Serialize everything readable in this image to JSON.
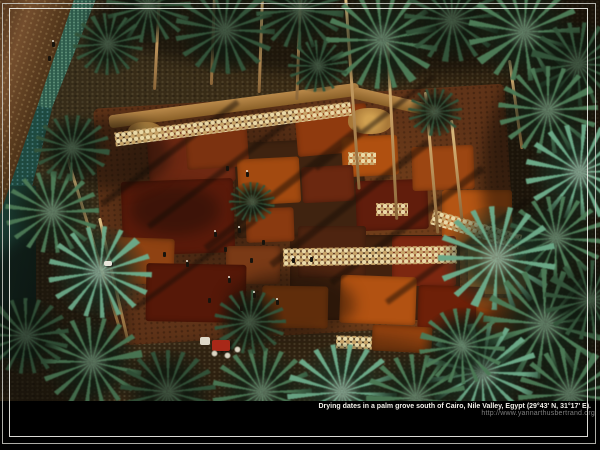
{
  "window": {
    "width": 600,
    "height": 450,
    "background": "#000000"
  },
  "caption": {
    "text": "Drying dates in a palm grove south of Cairo, Nile Valley, Egypt (29°43' N, 31°17' E).",
    "url": "http://www.yannarthusbertrand.org",
    "text_color": "#f2f0ea",
    "url_color": "#7e7e7e"
  },
  "frame": {
    "outer_color": "#cdcdc6",
    "inner_color": "#f3f2ec"
  },
  "photo": {
    "description": "Aerial photograph of dates spread to dry in red, orange and brown rectangular patches on the ground of a palm grove south of Cairo; tall palms cast long diagonal shadows; workers, rows of cream sacks, straw piles, a white donkey, a red tractor, a dirt road, an irrigation canal and teal-green crop fields border the scene.",
    "palette": {
      "ground": "#352818",
      "ground_light": "#4a3520",
      "field_teal": "#2e5c4c",
      "field_dark": "#1e4a40",
      "canal": "#16332a",
      "road": "#6b4528",
      "yard": "#5f3318",
      "straw": "#b9894a",
      "sack": "#ead9a6",
      "trunk": "#c9a065",
      "shadow": "#190f08",
      "tractor_red": "#a82818",
      "tractor_canopy": "#ded8c8",
      "animal_white": "#e9e6dc",
      "palm_variants": [
        {
          "frond": "#33543a",
          "hl": "rgba(150,180,150,.28)",
          "center": "rgba(16,26,16,.88)"
        },
        {
          "frond": "#4c7a56",
          "hl": "rgba(190,225,195,.35)",
          "center": "rgba(20,34,22,.85)"
        },
        {
          "frond": "#6ba887",
          "hl": "rgba(222,246,228,.4)",
          "center": "rgba(28,50,36,.8)"
        }
      ]
    },
    "patches": [
      {
        "x": 235,
        "y": 140,
        "w": 130,
        "h": 95,
        "c": "#3f2310",
        "r": -3
      },
      {
        "x": 290,
        "y": 235,
        "w": 170,
        "h": 85,
        "c": "#42210e",
        "r": 0
      },
      {
        "x": 148,
        "y": 126,
        "w": 86,
        "h": 58,
        "c": "#6e2812",
        "r": -4
      },
      {
        "x": 186,
        "y": 128,
        "w": 62,
        "h": 40,
        "c": "#7c3210",
        "r": -4
      },
      {
        "x": 122,
        "y": 180,
        "w": 112,
        "h": 74,
        "c": "#5a1a0a",
        "r": -2
      },
      {
        "x": 238,
        "y": 158,
        "w": 62,
        "h": 46,
        "c": "#a34a10",
        "r": -3
      },
      {
        "x": 296,
        "y": 106,
        "w": 72,
        "h": 48,
        "c": "#8f3a0e",
        "r": -5
      },
      {
        "x": 342,
        "y": 136,
        "w": 56,
        "h": 40,
        "c": "#b05010",
        "r": -3
      },
      {
        "x": 302,
        "y": 166,
        "w": 52,
        "h": 36,
        "c": "#6b2810",
        "r": -3
      },
      {
        "x": 356,
        "y": 180,
        "w": 72,
        "h": 50,
        "c": "#611d0c",
        "r": -2
      },
      {
        "x": 412,
        "y": 146,
        "w": 62,
        "h": 44,
        "c": "#9c4612",
        "r": -2
      },
      {
        "x": 442,
        "y": 190,
        "w": 70,
        "h": 54,
        "c": "#b45514",
        "r": 0
      },
      {
        "x": 468,
        "y": 246,
        "w": 58,
        "h": 48,
        "c": "#c0702a",
        "r": 0
      },
      {
        "x": 392,
        "y": 236,
        "w": 64,
        "h": 50,
        "c": "#7c2710",
        "r": 0
      },
      {
        "x": 298,
        "y": 226,
        "w": 68,
        "h": 52,
        "c": "#4e2410",
        "r": 0
      },
      {
        "x": 246,
        "y": 208,
        "w": 48,
        "h": 34,
        "c": "#8a3a10",
        "r": -2
      },
      {
        "x": 226,
        "y": 246,
        "w": 54,
        "h": 38,
        "c": "#7a3a16",
        "r": 0
      },
      {
        "x": 116,
        "y": 238,
        "w": 58,
        "h": 46,
        "c": "#8f4212",
        "r": 2
      },
      {
        "x": 146,
        "y": 264,
        "w": 100,
        "h": 58,
        "c": "#561808",
        "r": 1
      },
      {
        "x": 262,
        "y": 286,
        "w": 66,
        "h": 42,
        "c": "#a04a12",
        "r": 1
      },
      {
        "x": 340,
        "y": 276,
        "w": 76,
        "h": 48,
        "c": "#b25212",
        "r": 2
      },
      {
        "x": 418,
        "y": 286,
        "w": 66,
        "h": 44,
        "c": "#6e2008",
        "r": 2
      },
      {
        "x": 476,
        "y": 298,
        "w": 52,
        "h": 36,
        "c": "#a84c12",
        "r": 2
      },
      {
        "x": 372,
        "y": 326,
        "w": 60,
        "h": 26,
        "c": "#94420f",
        "r": 3
      }
    ],
    "straw_rows": [
      {
        "x": 108,
        "y": 99,
        "w": 252,
        "h": 13,
        "r": -7.5
      },
      {
        "x": 352,
        "y": 96,
        "w": 84,
        "h": 12,
        "r": 13
      }
    ],
    "straw_piles": [
      {
        "x": 348,
        "y": 108,
        "w": 44,
        "h": 26
      },
      {
        "x": 128,
        "y": 122,
        "w": 34,
        "h": 20
      }
    ],
    "shadow_lines": [
      {
        "x": 85,
        "y": 150,
        "w": 170,
        "h": 6,
        "r": -37
      },
      {
        "x": 130,
        "y": 168,
        "w": 185,
        "h": 6,
        "r": -37
      },
      {
        "x": 185,
        "y": 185,
        "w": 195,
        "h": 7,
        "r": -38
      },
      {
        "x": 250,
        "y": 200,
        "w": 200,
        "h": 7,
        "r": -38
      },
      {
        "x": 312,
        "y": 222,
        "w": 190,
        "h": 7,
        "r": -37
      },
      {
        "x": 370,
        "y": 248,
        "w": 175,
        "h": 6,
        "r": -36
      },
      {
        "x": 120,
        "y": 262,
        "w": 150,
        "h": 5,
        "r": -36
      },
      {
        "x": 300,
        "y": 120,
        "w": 150,
        "h": 5,
        "r": -38
      }
    ],
    "shadow_blobs": [
      {
        "x": 90,
        "y": -40,
        "w": 560,
        "h": 115,
        "c": "rgba(10,8,4,0.55)"
      },
      {
        "x": 482,
        "y": 40,
        "w": 180,
        "h": 280,
        "c": "rgba(10,8,4,0.5)"
      },
      {
        "x": 430,
        "y": 300,
        "w": 230,
        "h": 130,
        "c": "rgba(8,6,3,0.5)"
      },
      {
        "x": -25,
        "y": 230,
        "w": 150,
        "h": 190,
        "c": "rgba(8,6,3,0.5)"
      },
      {
        "x": 120,
        "y": 332,
        "w": 360,
        "h": 90,
        "c": "rgba(30,20,10,0.35)"
      },
      {
        "x": 225,
        "y": 272,
        "w": 130,
        "h": 65,
        "c": "rgba(18,10,5,0.45)"
      },
      {
        "x": 130,
        "y": 185,
        "w": 90,
        "h": 50,
        "c": "rgba(18,10,5,0.4)"
      },
      {
        "x": 58,
        "y": 118,
        "w": 112,
        "h": 72,
        "c": "rgba(12,8,4,0.45)"
      }
    ],
    "sack_rows": [
      {
        "x": 114,
        "y": 117,
        "w": 238,
        "h": 14,
        "r": -7.5
      },
      {
        "x": 283,
        "y": 247,
        "w": 174,
        "h": 18,
        "r": -1
      },
      {
        "x": 430,
        "y": 222,
        "w": 92,
        "h": 15,
        "r": 16
      },
      {
        "x": 348,
        "y": 152,
        "w": 28,
        "h": 13,
        "r": 0
      },
      {
        "x": 376,
        "y": 203,
        "w": 32,
        "h": 13,
        "r": 0
      },
      {
        "x": 336,
        "y": 336,
        "w": 36,
        "h": 13,
        "r": 2
      }
    ],
    "trunks": [
      {
        "x": 344,
        "y": -5,
        "h": 195,
        "r": -4
      },
      {
        "x": 386,
        "y": 42,
        "h": 178,
        "r": -3
      },
      {
        "x": 299,
        "y": -5,
        "h": 105,
        "r": 2
      },
      {
        "x": 158,
        "y": -5,
        "h": 95,
        "r": 3
      },
      {
        "x": 213,
        "y": -5,
        "h": 90,
        "r": 2
      },
      {
        "x": 261,
        "y": -5,
        "h": 98,
        "r": 2
      },
      {
        "x": 424,
        "y": 92,
        "h": 142,
        "r": -5
      },
      {
        "x": 66,
        "y": 158,
        "h": 175,
        "r": -17
      },
      {
        "x": 98,
        "y": 218,
        "h": 128,
        "r": -13
      },
      {
        "x": 450,
        "y": 120,
        "h": 100,
        "r": -6
      },
      {
        "x": 508,
        "y": 60,
        "h": 90,
        "r": -8
      }
    ],
    "palms": [
      {
        "x": 148,
        "y": 6,
        "d": 85
      },
      {
        "x": 225,
        "y": 30,
        "d": 100
      },
      {
        "x": 300,
        "y": 10,
        "d": 88
      },
      {
        "x": 382,
        "y": 40,
        "d": 112,
        "l": 1
      },
      {
        "x": 452,
        "y": 20,
        "d": 96
      },
      {
        "x": 524,
        "y": 32,
        "d": 112,
        "l": 1
      },
      {
        "x": 578,
        "y": 64,
        "d": 96
      },
      {
        "x": 108,
        "y": 44,
        "d": 70
      },
      {
        "x": 318,
        "y": 66,
        "d": 60
      },
      {
        "x": 548,
        "y": 110,
        "d": 100,
        "l": 1
      },
      {
        "x": 580,
        "y": 172,
        "d": 110,
        "l": 2
      },
      {
        "x": 556,
        "y": 238,
        "d": 96,
        "l": 1
      },
      {
        "x": 497,
        "y": 258,
        "d": 118,
        "l": 2
      },
      {
        "x": 545,
        "y": 324,
        "d": 124,
        "l": 1
      },
      {
        "x": 590,
        "y": 300,
        "d": 92
      },
      {
        "x": 482,
        "y": 372,
        "d": 112,
        "l": 2
      },
      {
        "x": 570,
        "y": 394,
        "d": 104,
        "l": 1
      },
      {
        "x": 92,
        "y": 362,
        "d": 102,
        "l": 1
      },
      {
        "x": 168,
        "y": 392,
        "d": 96
      },
      {
        "x": 262,
        "y": 392,
        "d": 100,
        "l": 1
      },
      {
        "x": 342,
        "y": 392,
        "d": 110,
        "l": 2
      },
      {
        "x": 416,
        "y": 398,
        "d": 100,
        "l": 1
      },
      {
        "x": 26,
        "y": 336,
        "d": 86
      },
      {
        "x": 52,
        "y": 212,
        "d": 94,
        "l": 1
      },
      {
        "x": 100,
        "y": 272,
        "d": 104,
        "l": 2
      },
      {
        "x": 72,
        "y": 148,
        "d": 76
      },
      {
        "x": 252,
        "y": 202,
        "d": 46
      },
      {
        "x": 435,
        "y": 112,
        "d": 54
      },
      {
        "x": 250,
        "y": 322,
        "d": 72
      },
      {
        "x": 462,
        "y": 346,
        "d": 86,
        "l": 1
      }
    ],
    "people": [
      {
        "x": 214,
        "y": 232
      },
      {
        "x": 224,
        "y": 247
      },
      {
        "x": 238,
        "y": 228
      },
      {
        "x": 250,
        "y": 258
      },
      {
        "x": 228,
        "y": 278
      },
      {
        "x": 208,
        "y": 298
      },
      {
        "x": 253,
        "y": 293
      },
      {
        "x": 262,
        "y": 240
      },
      {
        "x": 186,
        "y": 262
      },
      {
        "x": 226,
        "y": 166
      },
      {
        "x": 246,
        "y": 172
      },
      {
        "x": 163,
        "y": 252
      },
      {
        "x": 276,
        "y": 300
      },
      {
        "x": 240,
        "y": 306
      },
      {
        "x": 52,
        "y": 42
      },
      {
        "x": 48,
        "y": 56
      },
      {
        "x": 292,
        "y": 258
      },
      {
        "x": 310,
        "y": 257
      }
    ],
    "animal": {
      "x": 104,
      "y": 261,
      "w": 8,
      "h": 5
    },
    "tractor": {
      "x": 200,
      "y": 334,
      "canopy": {
        "x": 0,
        "y": 3,
        "w": 10,
        "h": 8
      },
      "body": {
        "x": 12,
        "y": 6,
        "w": 18,
        "h": 11
      },
      "wheels": [
        [
          11,
          16
        ],
        [
          24,
          18
        ],
        [
          34,
          12
        ]
      ]
    }
  }
}
